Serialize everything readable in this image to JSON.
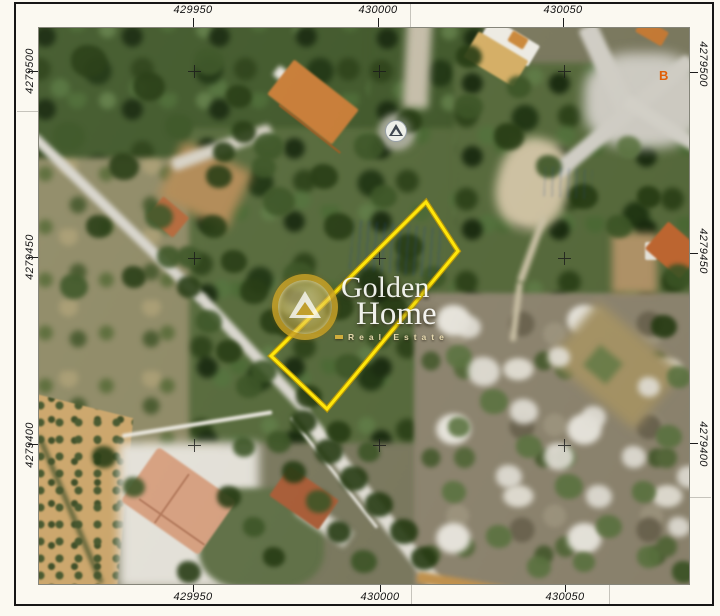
{
  "map": {
    "grid": {
      "x_labels": [
        "429950",
        "430000",
        "430050"
      ],
      "y_labels": [
        "4279500",
        "4279450",
        "4279400"
      ]
    },
    "markers": {
      "point_b": "B"
    },
    "watermark": {
      "line1": "Golden",
      "line2": "Home",
      "line3": "Real Estate"
    },
    "parcel": {
      "stroke_color": "#ffe60a"
    },
    "colors": {
      "paper": "#fbf9f1",
      "frame": "#161616",
      "parcel_yellow": "#ffe60a",
      "watermark_gold": "#c69e22",
      "point_b_orange": "#e05f08"
    }
  }
}
